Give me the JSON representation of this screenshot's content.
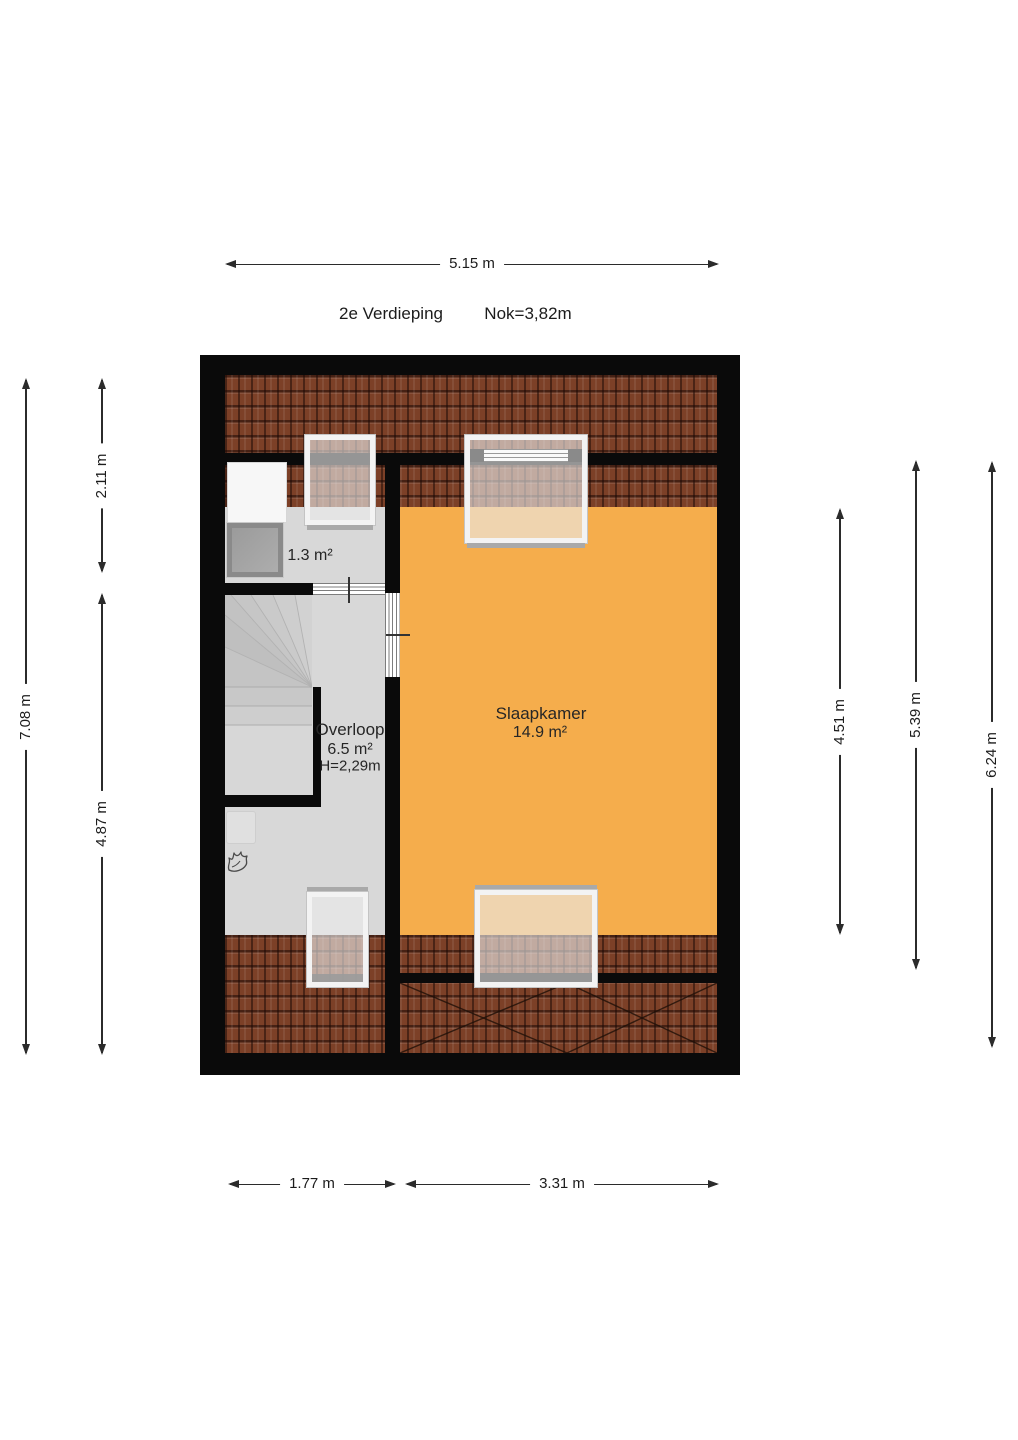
{
  "title": {
    "floor_label": "2e Verdieping",
    "ridge_label": "Nok=3,82m"
  },
  "dimensions": {
    "top_width": "5.15 m",
    "left_total_height": "7.08 m",
    "left_upper": "2.11 m",
    "left_lower": "4.87 m",
    "right_bedroom": "4.51 m",
    "right_middle": "5.39 m",
    "right_outer": "6.24 m",
    "bottom_left_width": "1.77 m",
    "bottom_right_width": "3.31 m"
  },
  "rooms": {
    "storage": {
      "area_label": "1.3 m²"
    },
    "landing": {
      "name_label": "Overloop",
      "area_label": "6.5 m²",
      "height_label": "H=2,29m"
    },
    "bedroom": {
      "name_label": "Slaapkamer",
      "area_label": "14.9 m²"
    }
  },
  "colors": {
    "bedroom_floor": "#F5AD4C",
    "landing_floor": "#D8D8D8",
    "roof_tile": "#7C4027",
    "wall": "#0A0A0A",
    "dimension_line": "#2B2B2B"
  }
}
